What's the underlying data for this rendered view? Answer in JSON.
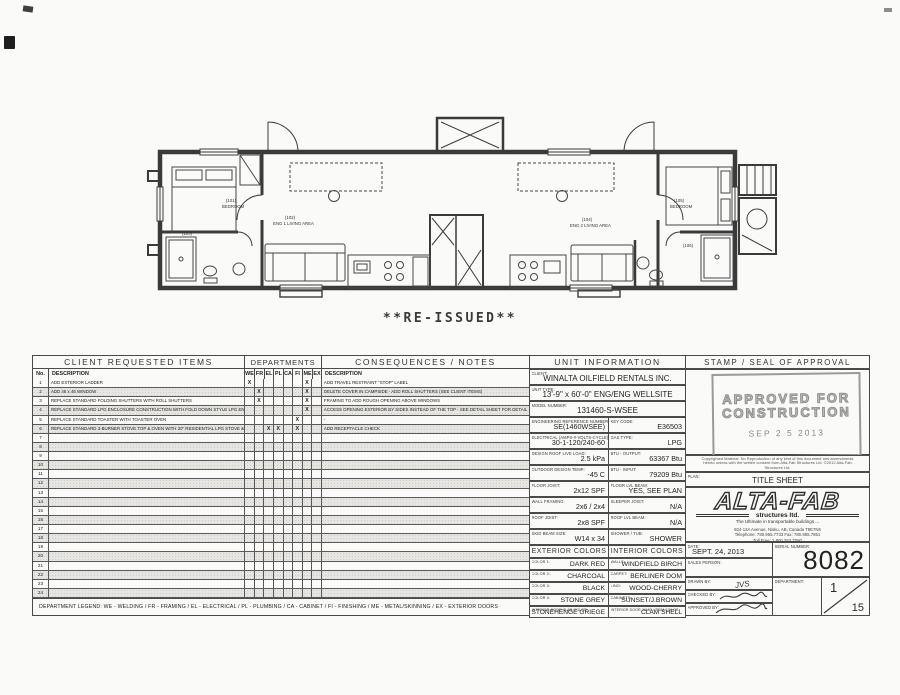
{
  "page": {
    "reissued": "**RE-ISSUED**"
  },
  "floor_plan": {
    "labels": {
      "bedroom_left_no": "(101)",
      "bedroom_left": "BEDROOM",
      "bath_left_no": "(103)",
      "living1_no": "(102)",
      "living1": "ENG 1 LIVING AREA",
      "living2_no": "(104)",
      "living2": "ENG 2 LIVING AREA",
      "bath_right_no": "(106)",
      "bedroom_right_no": "(105)",
      "bedroom_right": "BEDROOM"
    }
  },
  "client_items": {
    "title": "CLIENT REQUESTED ITEMS",
    "no_header": "No.",
    "description_header": "DESCRIPTION",
    "rows": [
      {
        "no": "1",
        "desc": "ADD EXTERIOR LADDER",
        "depts": [
          "WE",
          "ME"
        ],
        "note": "ADD TRAVEL RESTRAINT \"STOP\" LABEL"
      },
      {
        "no": "2",
        "desc": "ADD 46 x 46 WINDOW",
        "depts": [
          "FR",
          "ME"
        ],
        "note": "DELETE COVER IN CAMPSIDE - ADD ROLL SHUTTERS (SEE CLIENT ITEMS)"
      },
      {
        "no": "3",
        "desc": "REPLACE STANDARD FOLDING SHUTTERS WITH ROLL SHUTTERS",
        "depts": [
          "FR",
          "ME"
        ],
        "note": "FRAMING TO ADD ROUGH OPENING ABOVE WINDOWS"
      },
      {
        "no": "4",
        "desc": "REPLACE STANDARD LPG ENCLOSURE CONSTRUCTION WITH FOLD DOWN STYLE LPG ENCLOSURE",
        "depts": [
          "ME"
        ],
        "note": "ACCESS OPENING EXTERIOR BY SIDES INSTEAD OF THE TOP - SEE DETAIL SHEET FOR DETAIL"
      },
      {
        "no": "5",
        "desc": "REPLACE STANDARD TOASTER WITH TOASTER OVEN",
        "depts": [
          "FI"
        ],
        "note": "-"
      },
      {
        "no": "6",
        "desc": "REPLACE STANDARD 3-BURNER STOVE TOP & OVEN WITH 30\" RESIDENTIAL LPG STOVE & OVEN",
        "depts": [
          "EL",
          "PL",
          "FI"
        ],
        "note": "ADD RECEPTACLE CHECK"
      },
      {
        "no": "7"
      },
      {
        "no": "8"
      },
      {
        "no": "9"
      },
      {
        "no": "10"
      },
      {
        "no": "11"
      },
      {
        "no": "12"
      },
      {
        "no": "13"
      },
      {
        "no": "14"
      },
      {
        "no": "15"
      },
      {
        "no": "16"
      },
      {
        "no": "17"
      },
      {
        "no": "18"
      },
      {
        "no": "19"
      },
      {
        "no": "20"
      },
      {
        "no": "21"
      },
      {
        "no": "22"
      },
      {
        "no": "23"
      },
      {
        "no": "24"
      }
    ]
  },
  "departments": {
    "title": "DEPARTMENTS",
    "columns": [
      "WE",
      "FR",
      "EL",
      "PL",
      "CA",
      "FI",
      "ME",
      "EX"
    ],
    "mark": "X"
  },
  "consequences": {
    "title": "CONSEQUENCES / NOTES",
    "description_header": "DESCRIPTION"
  },
  "unit_info": {
    "title": "UNIT INFORMATION",
    "client": {
      "label": "CLIENT:",
      "value": "WINALTA OILFIELD RENTALS INC."
    },
    "unit_type": {
      "label": "UNIT TYPE:",
      "value": "13'-9\" x 60'-0\" ENG/ENG WELLSITE"
    },
    "model_number": {
      "label": "MODEL NUMBER:",
      "value": "131460-S-WSEE"
    },
    "eng_ref": {
      "label": "ENGINEERING REFERENCE NUMBER:",
      "value": "SE(1460WSEE)"
    },
    "key_code": {
      "label": "KEY CODE:",
      "value": "E36503"
    },
    "electrical": {
      "label": "ELECTRICAL (AMPS-#-VOLTS-CYCLE):",
      "value": "30-1-120/240-60"
    },
    "gas_type": {
      "label": "GAS TYPE:",
      "value": "LPG"
    },
    "roof_load": {
      "label": "DESIGN ROOF LIVE LOAD:",
      "value": "2.5 kPa"
    },
    "btu_output": {
      "label": "BTU - OUTPUT:",
      "value": "63367 Btu"
    },
    "design_temp": {
      "label": "OUTDOOR DESIGN TEMP.:",
      "value": "-45 C"
    },
    "btu_input": {
      "label": "BTU - INPUT:",
      "value": "79209 Btu"
    },
    "floor_joist": {
      "label": "FLOOR JOIST:",
      "value": "2x12 SPF"
    },
    "floor_lvl_beam": {
      "label": "FLOOR LVL BEAM:",
      "value": "YES, SEE PLAN"
    },
    "wall_framing": {
      "label": "WALL FRAMING:",
      "value": "2x6 / 2x4"
    },
    "sleeper_joist": {
      "label": "SLEEPER JOIST:",
      "value": "N/A"
    },
    "roof_joist": {
      "label": "ROOF JOIST:",
      "value": "2x8 SPF"
    },
    "roof_lvl_beam": {
      "label": "ROOF LVL BEAM:",
      "value": "N/A"
    },
    "skid_beam": {
      "label": "SKID BEAM SIZE:",
      "value": "W14 x 34"
    },
    "shower_tub": {
      "label": "SHOWER / TUB:",
      "value": "SHOWER"
    },
    "exterior_colors_header": "EXTERIOR COLORS",
    "interior_colors_header": "INTERIOR COLORS",
    "color1": {
      "label": "COLOR 1:",
      "value": "DARK RED"
    },
    "walls": {
      "label": "WALLS:",
      "value": "WINDFIELD BIRCH"
    },
    "color2": {
      "label": "COLOR 2:",
      "value": "CHARCOAL"
    },
    "carpet": {
      "label": "CARPET:",
      "value": "BERLINER DOM"
    },
    "color3": {
      "label": "COLOR 3:",
      "value": "BLACK"
    },
    "lino": {
      "label": "LINO:",
      "value": "WOOD-CHERRY"
    },
    "color4": {
      "label": "COLOR 4:",
      "value": "STONE GREY"
    },
    "cabinets": {
      "label": "CABINETS:",
      "value": "SUNSET/J.BROWN"
    },
    "int_door_slab": {
      "label": "INTERIOR DOOR SLAB COLOR:",
      "value": "STONEHENGE GRIEGE"
    },
    "int_door_trim": {
      "label": "INTERIOR DOOR JAMB / TRIM COLOR:",
      "value": "CLAM SHELL"
    }
  },
  "approval": {
    "title": "STAMP / SEAL OF APPROVAL",
    "stamp_line1": "APPROVED FOR",
    "stamp_line2": "CONSTRUCTION",
    "stamp_date": "SEP 2 5 2013",
    "copyright": "Copyrighted Material. No Reproduction of any kind of this document and amendments hereto unless with the written consent from Alta-Fab Structures Ltd.  ©2012 Alta-Fab Structures Ltd.",
    "plan_label": "PLAN:",
    "plan_value": "TITLE SHEET",
    "logo_text": "ALTA-FAB",
    "logo_sub": "structures ltd.",
    "logo_tagline": "The Ultimate in transportable buildings ...",
    "address_line1": "604-13A Avenue, Nisku, AB, Canada T9E7N6",
    "address_line2": "Telephone: 780.955.7733    Fax: 780.955.7851",
    "address_line3": "Toll Free: 1.800.252.7090",
    "date_label": "DATE:",
    "date_value": "SEPT. 24, 2013",
    "serial_label": "SERIAL NUMBER:",
    "serial_value": "8082",
    "sales_label": "SALES PERSON:",
    "drawn_label": "DRAWN BY:",
    "drawn_value": "JVS",
    "checked_label": "CHECKED BY:",
    "approved_label": "APPROVED BY:",
    "department_label": "DEPARTMENT:",
    "page_current": "1",
    "page_total": "15"
  },
  "legend": "DEPARTMENT LEGEND: WE - WELDING / FR - FRAMING / EL - ELECTRICAL / PL - PLUMBING / CA - CABINET / FI - FINISHING / ME - METAL/SKINNING / EX - EXTERIOR DOORS"
}
